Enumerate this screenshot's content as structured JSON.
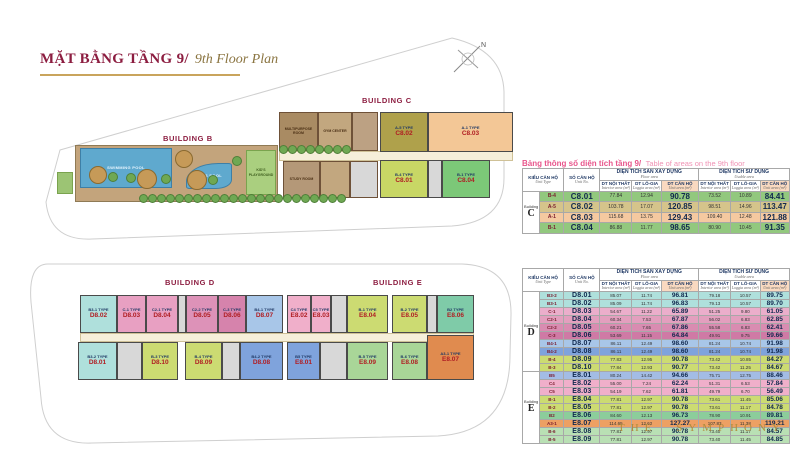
{
  "title": {
    "vi": "MẶT BẰNG TẦNG 9/",
    "en": "9th Floor Plan"
  },
  "brand": "THE SYMPHONY",
  "compass": {
    "north_label": "N"
  },
  "caption": {
    "vi": "Bảng thông số diện tích tầng 9/",
    "en": "Table of areas on the 9th floor"
  },
  "colors": {
    "title_maroon": "#8C1D40",
    "gold": "#B08D3E",
    "caption_pink": "#E8558B",
    "navy": "#1F3864",
    "unit_number_red": "#B01E23",
    "header_peach": "#F9D9C0"
  },
  "table_headers": {
    "unit_type": {
      "vi": "KIỂU CĂN HỘ",
      "en": "Unit Type"
    },
    "unit_no": {
      "vi": "SỐ CĂN HỘ",
      "en": "Unit No."
    },
    "floor_area_group": {
      "vi": "DIỆN TÍCH SÀN XÂY DỰNG",
      "en": "Floor area"
    },
    "usable_area_group": {
      "vi": "DIỆN TÍCH SỬ DỤNG",
      "en": "Usable area"
    },
    "interior": {
      "vi": "DT NỘI THẤT",
      "en": "Interior area (m²)"
    },
    "loggia": {
      "vi": "DT LÔ-GIA",
      "en": "Loggia area (m²)"
    },
    "unit_area": {
      "vi": "DT CĂN HỘ",
      "en": "Unit area (m²)"
    },
    "building_word": "Building"
  },
  "tables": [
    {
      "name": "building-c-areas",
      "sections": [
        {
          "letter": "C",
          "rows": [
            {
              "type": "B-4",
              "no": "C8.01",
              "v": [
                "77.84",
                "12.94",
                "90.78",
                "73.52",
                "10.89",
                "84.41"
              ],
              "color": "#92C87E"
            },
            {
              "type": "A-5",
              "no": "C8.02",
              "v": [
                "103.78",
                "17.07",
                "120.85",
                "98.51",
                "14.96",
                "113.47"
              ],
              "color": "#D5C48B"
            },
            {
              "type": "A-1",
              "no": "C8.03",
              "v": [
                "115.68",
                "13.75",
                "129.43",
                "109.40",
                "12.48",
                "121.88"
              ],
              "color": "#F5C9A0"
            },
            {
              "type": "B-1",
              "no": "C8.04",
              "v": [
                "86.88",
                "11.77",
                "98.65",
                "80.90",
                "10.45",
                "91.35"
              ],
              "color": "#92C87E"
            }
          ]
        }
      ]
    },
    {
      "name": "buildings-d-e-areas",
      "sections": [
        {
          "letter": "D",
          "rows": [
            {
              "type": "B3-2",
              "no": "D8.01",
              "v": [
                "85.07",
                "11.74",
                "96.81",
                "79.18",
                "10.57",
                "89.75"
              ],
              "color": "#AFE0DC"
            },
            {
              "type": "B3-1",
              "no": "D8.02",
              "v": [
                "85.09",
                "11.74",
                "96.83",
                "79.13",
                "10.57",
                "89.70"
              ],
              "color": "#AFE0DC"
            },
            {
              "type": "C-1",
              "no": "D8.03",
              "v": [
                "54.67",
                "11.22",
                "65.89",
                "51.25",
                "9.80",
                "61.05"
              ],
              "color": "#EBAECB"
            },
            {
              "type": "C2-1",
              "no": "D8.04",
              "v": [
                "60.34",
                "7.53",
                "67.87",
                "56.02",
                "6.83",
                "62.85"
              ],
              "color": "#E39FBE"
            },
            {
              "type": "C2-2",
              "no": "D8.05",
              "v": [
                "60.21",
                "7.65",
                "67.86",
                "55.58",
                "6.83",
                "62.41"
              ],
              "color": "#D98CB1"
            },
            {
              "type": "C-3",
              "no": "D8.06",
              "v": [
                "53.69",
                "11.15",
                "64.84",
                "49.91",
                "9.75",
                "59.66"
              ],
              "color": "#CF7AA5"
            },
            {
              "type": "B4-1",
              "no": "D8.07",
              "v": [
                "86.11",
                "12.49",
                "98.60",
                "81.24",
                "10.74",
                "91.98"
              ],
              "color": "#A8C6E8"
            },
            {
              "type": "B4-2",
              "no": "D8.08",
              "v": [
                "86.11",
                "12.49",
                "98.60",
                "81.24",
                "10.74",
                "91.98"
              ],
              "color": "#7FA3DC"
            },
            {
              "type": "B-4",
              "no": "D8.09",
              "v": [
                "77.83",
                "12.95",
                "90.78",
                "73.42",
                "10.85",
                "84.27"
              ],
              "color": "#CCDB72"
            },
            {
              "type": "B-3",
              "no": "D8.10",
              "v": [
                "77.84",
                "12.93",
                "90.77",
                "73.42",
                "11.25",
                "84.67"
              ],
              "color": "#CCDB72"
            }
          ]
        },
        {
          "letter": "E",
          "rows": [
            {
              "type": "B5",
              "no": "E8.01",
              "v": [
                "80.24",
                "14.42",
                "94.66",
                "75.71",
                "12.75",
                "88.46"
              ],
              "color": "#A3BCE4"
            },
            {
              "type": "C4",
              "no": "E8.02",
              "v": [
                "55.00",
                "7.24",
                "62.24",
                "51.31",
                "6.53",
                "57.84"
              ],
              "color": "#F0AFCA"
            },
            {
              "type": "C5",
              "no": "E8.03",
              "v": [
                "54.19",
                "7.62",
                "61.81",
                "49.79",
                "6.70",
                "56.49"
              ],
              "color": "#F0AFCA"
            },
            {
              "type": "B-1",
              "no": "E8.04",
              "v": [
                "77.81",
                "12.97",
                "90.78",
                "73.61",
                "11.45",
                "85.06"
              ],
              "color": "#CCDB72"
            },
            {
              "type": "B-2",
              "no": "E8.05",
              "v": [
                "77.81",
                "12.97",
                "90.78",
                "73.61",
                "11.17",
                "84.78"
              ],
              "color": "#CCDB72"
            },
            {
              "type": "B2",
              "no": "E8.06",
              "v": [
                "84.60",
                "12.13",
                "96.73",
                "78.90",
                "10.91",
                "89.81"
              ],
              "color": "#8CCD9B"
            },
            {
              "type": "A3-1",
              "no": "E8.07",
              "v": [
                "114.65",
                "12.62",
                "127.27",
                "107.83",
                "11.38",
                "119.21"
              ],
              "color": "#EDA063"
            },
            {
              "type": "B-6",
              "no": "E8.08",
              "v": [
                "77.81",
                "12.97",
                "90.78",
                "73.40",
                "11.17",
                "84.57"
              ],
              "color": "#B9E0B4"
            },
            {
              "type": "B-5",
              "no": "E8.09",
              "v": [
                "77.81",
                "12.97",
                "90.78",
                "73.40",
                "11.45",
                "84.85"
              ],
              "color": "#B9E0B4"
            }
          ]
        }
      ]
    }
  ],
  "plan": {
    "b": {
      "label": "BUILDING B",
      "label_pos": [
        163,
        134
      ],
      "deck": [
        75,
        145,
        203,
        57
      ],
      "pool": {
        "rect": [
          80,
          148,
          92,
          40
        ],
        "label": "SWIMMING POOL"
      },
      "kidpool": {
        "rect": [
          186,
          163,
          46,
          26
        ],
        "label": "KID'S POOL"
      },
      "playground": {
        "rect": [
          246,
          150,
          30,
          45
        ],
        "label": "KID'S PLAYGROUND"
      },
      "lawns": [
        [
          57,
          172,
          16,
          22
        ]
      ],
      "trees": [
        {
          "kind": "tan",
          "x": 97,
          "y": 174,
          "r": 8
        },
        {
          "kind": "tan",
          "x": 146,
          "y": 178,
          "r": 9
        },
        {
          "kind": "tan",
          "x": 196,
          "y": 179,
          "r": 9
        },
        {
          "kind": "tan",
          "x": 183,
          "y": 158,
          "r": 8
        },
        {
          "kind": "green",
          "x": 112,
          "y": 176,
          "r": 4
        },
        {
          "kind": "green",
          "x": 130,
          "y": 177,
          "r": 4
        },
        {
          "kind": "green",
          "x": 165,
          "y": 178,
          "r": 4
        },
        {
          "kind": "green",
          "x": 212,
          "y": 179,
          "r": 4
        },
        {
          "kind": "green",
          "x": 236,
          "y": 160,
          "r": 4
        }
      ],
      "hedges": [
        {
          "x1": 142,
          "x2": 344,
          "y": 197,
          "r": 3.5
        },
        {
          "x1": 282,
          "x2": 348,
          "y": 148,
          "r": 3.5
        }
      ]
    },
    "c": {
      "label": "BUILDING C",
      "label_pos": [
        362,
        96
      ],
      "corridors": [
        [
          279,
          151,
          234,
          10
        ]
      ],
      "rooms": [
        {
          "rect": [
            279,
            112,
            39,
            39
          ],
          "color": "#A98B63",
          "label": "MULTIPURPOSE ROOM"
        },
        {
          "rect": [
            318,
            112,
            34,
            39
          ],
          "color": "#C2A77F",
          "label": "GYM CENTER"
        },
        {
          "rect": [
            352,
            112,
            26,
            39
          ],
          "color": "#BCA183",
          "label": ""
        },
        {
          "rect": [
            283,
            161,
            37,
            37
          ],
          "color": "#B49878",
          "label": "STUDY ROOM"
        },
        {
          "rect": [
            320,
            161,
            30,
            37
          ],
          "color": "#C2A77F",
          "label": ""
        },
        {
          "rect": [
            350,
            161,
            28,
            37
          ],
          "color": "#D8D8D8",
          "label": ""
        }
      ],
      "units": [
        {
          "rect": [
            380,
            112,
            48,
            40
          ],
          "color": "#AFA14B",
          "type": "A-5 TYPE",
          "no": "C8.02"
        },
        {
          "rect": [
            428,
            112,
            85,
            40
          ],
          "color": "#F3C796",
          "type": "A-1 TYPE",
          "no": "C8.03"
        },
        {
          "rect": [
            380,
            160,
            48,
            38
          ],
          "color": "#C8D765",
          "type": "B-4 TYPE",
          "no": "C8.01"
        },
        {
          "rect": [
            428,
            160,
            14,
            38
          ],
          "color": "#D8D8D8",
          "type": "",
          "no": ""
        },
        {
          "rect": [
            442,
            160,
            48,
            38
          ],
          "color": "#7CC878",
          "type": "B-1 TYPE",
          "no": "C8.04"
        }
      ]
    },
    "d": {
      "label": "BUILDING D",
      "label_pos": [
        165,
        278
      ],
      "corridors": [
        [
          80,
          333,
          394,
          9
        ]
      ],
      "units": [
        {
          "rect": [
            80,
            295,
            37,
            38
          ],
          "color": "#AFE0DC",
          "type": "B3-1 TYPE",
          "no": "D8.02"
        },
        {
          "rect": [
            117,
            295,
            29,
            38
          ],
          "color": "#E8A0C2",
          "type": "C-1 TYPE",
          "no": "D8.03"
        },
        {
          "rect": [
            146,
            295,
            32,
            38
          ],
          "color": "#E8A0C2",
          "type": "C2-1 TYPE",
          "no": "D8.04"
        },
        {
          "rect": [
            178,
            295,
            8,
            38
          ],
          "color": "#D8D8D8",
          "type": "",
          "no": ""
        },
        {
          "rect": [
            186,
            295,
            32,
            38
          ],
          "color": "#DD92B8",
          "type": "C2-2 TYPE",
          "no": "D8.05"
        },
        {
          "rect": [
            218,
            295,
            28,
            38
          ],
          "color": "#D683AC",
          "type": "C-3 TYPE",
          "no": "D8.06"
        },
        {
          "rect": [
            246,
            295,
            37,
            38
          ],
          "color": "#A8C6E8",
          "type": "B4-1 TYPE",
          "no": "D8.07"
        },
        {
          "rect": [
            78,
            342,
            39,
            38
          ],
          "color": "#AFE0DC",
          "type": "B3-2 TYPE",
          "no": "D8.01"
        },
        {
          "rect": [
            117,
            342,
            25,
            38
          ],
          "color": "#D8D8D8",
          "type": "",
          "no": ""
        },
        {
          "rect": [
            142,
            342,
            36,
            38
          ],
          "color": "#CCDB72",
          "type": "B-3 TYPE",
          "no": "D8.10"
        },
        {
          "rect": [
            185,
            342,
            37,
            38
          ],
          "color": "#CCDB72",
          "type": "B-4 TYPE",
          "no": "D8.09"
        },
        {
          "rect": [
            222,
            342,
            18,
            38
          ],
          "color": "#D8D8D8",
          "type": "",
          "no": ""
        },
        {
          "rect": [
            240,
            342,
            43,
            38
          ],
          "color": "#7FA3DC",
          "type": "B4-2 TYPE",
          "no": "D8.08"
        }
      ]
    },
    "e": {
      "label": "BUILDING E",
      "label_pos": [
        373,
        278
      ],
      "corridors": [],
      "units": [
        {
          "rect": [
            287,
            295,
            24,
            38
          ],
          "color": "#F0AFCA",
          "type": "C4 TYPE",
          "no": "E8.02"
        },
        {
          "rect": [
            311,
            295,
            20,
            38
          ],
          "color": "#F0AFCA",
          "type": "C5 TYPE",
          "no": "E8.03"
        },
        {
          "rect": [
            331,
            295,
            16,
            38
          ],
          "color": "#D8D8D8",
          "type": "",
          "no": ""
        },
        {
          "rect": [
            347,
            295,
            41,
            38
          ],
          "color": "#CCDB72",
          "type": "B-1 TYPE",
          "no": "E8.04"
        },
        {
          "rect": [
            392,
            295,
            35,
            38
          ],
          "color": "#CCDB72",
          "type": "B-2 TYPE",
          "no": "E8.05"
        },
        {
          "rect": [
            427,
            295,
            10,
            38
          ],
          "color": "#D8D8D8",
          "type": "",
          "no": ""
        },
        {
          "rect": [
            437,
            295,
            37,
            38
          ],
          "color": "#7FCBA8",
          "type": "B2 TYPE",
          "no": "E8.06"
        },
        {
          "rect": [
            287,
            342,
            33,
            38
          ],
          "color": "#7FA3DC",
          "type": "B5 TYPE",
          "no": "E8.01"
        },
        {
          "rect": [
            320,
            342,
            27,
            38
          ],
          "color": "#D8D8D8",
          "type": "",
          "no": ""
        },
        {
          "rect": [
            347,
            342,
            41,
            38
          ],
          "color": "#A9D698",
          "type": "B-5 TYPE",
          "no": "E8.09"
        },
        {
          "rect": [
            392,
            342,
            35,
            38
          ],
          "color": "#A9D698",
          "type": "B-6 TYPE",
          "no": "E8.08"
        },
        {
          "rect": [
            427,
            335,
            47,
            45
          ],
          "color": "#E08B4F",
          "type": "A3-1 TYPE",
          "no": "E8.07"
        }
      ]
    }
  }
}
